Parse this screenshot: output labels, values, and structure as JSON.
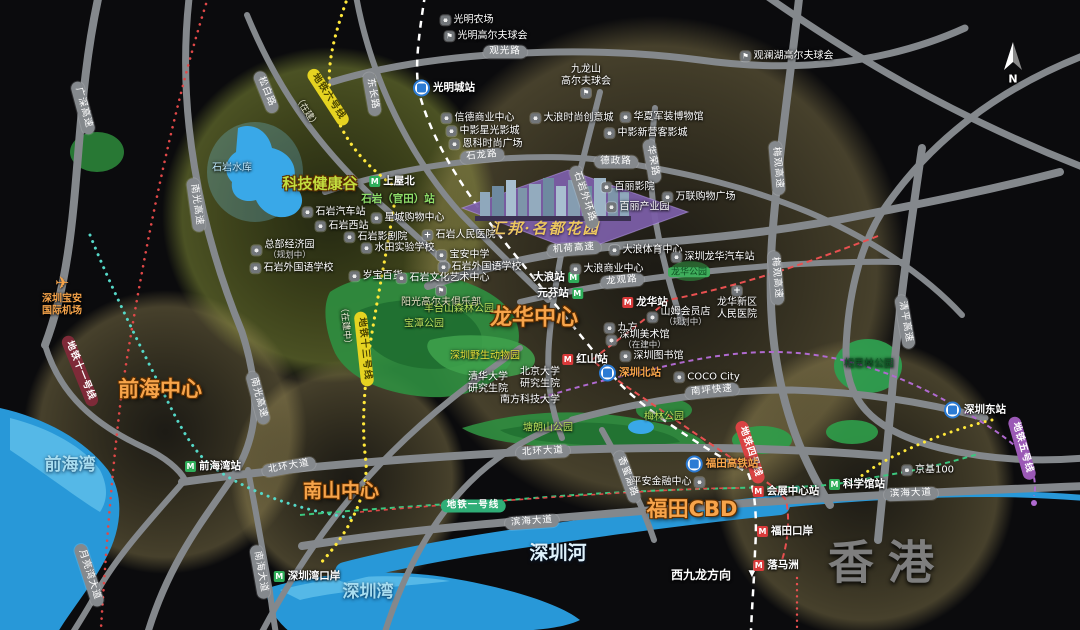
{
  "map": {
    "property": {
      "name": "汇邦·名都花园",
      "x": 545,
      "y": 228
    },
    "compass": {
      "label": "N"
    },
    "regions": [
      {
        "t": "科技健康谷",
        "x": 320,
        "y": 184,
        "s": 15,
        "c": "#c3dd3e"
      },
      {
        "t": "前海中心",
        "x": 160,
        "y": 389,
        "s": 21,
        "c": "#f7a44a"
      },
      {
        "t": "南山中心",
        "x": 341,
        "y": 492,
        "s": 19,
        "c": "#f7a44a"
      },
      {
        "t": "龙华中心",
        "x": 534,
        "y": 318,
        "s": 22,
        "c": "#f7a44a"
      },
      {
        "t": "福田CBD",
        "x": 692,
        "y": 509,
        "s": 21,
        "c": "#f7a44a"
      },
      {
        "t": "香港",
        "x": 888,
        "y": 563,
        "s": 46,
        "c": "#7e7e7e",
        "ls": 14,
        "hk": true
      }
    ],
    "water_labels": [
      {
        "t": "前海湾",
        "x": 70,
        "y": 466
      },
      {
        "t": "深圳湾",
        "x": 368,
        "y": 593
      },
      {
        "t": "深圳河",
        "x": 558,
        "y": 554,
        "s": 19,
        "c": "#dff2fc"
      }
    ],
    "roads": [
      {
        "t": "广深高速",
        "x": 83,
        "y": 108,
        "r": 75
      },
      {
        "t": "松白路",
        "x": 266,
        "y": 92,
        "r": 68
      },
      {
        "t": "东长路",
        "x": 372,
        "y": 94,
        "r": 80
      },
      {
        "t": "南光高速",
        "x": 196,
        "y": 205,
        "r": 82
      },
      {
        "t": "南光高速",
        "x": 258,
        "y": 398,
        "r": 75
      },
      {
        "t": "观光路",
        "x": 505,
        "y": 52,
        "r": 0
      },
      {
        "t": "石龙路",
        "x": 482,
        "y": 156,
        "r": -6
      },
      {
        "t": "德政路",
        "x": 616,
        "y": 162,
        "r": 0
      },
      {
        "t": "华荣路",
        "x": 652,
        "y": 161,
        "r": 80
      },
      {
        "t": "石岩外环路",
        "x": 584,
        "y": 197,
        "r": 72
      },
      {
        "t": "机荷高速",
        "x": 574,
        "y": 249,
        "r": -4
      },
      {
        "t": "龙观路",
        "x": 622,
        "y": 281,
        "r": -5
      },
      {
        "t": "梅观高速",
        "x": 777,
        "y": 168,
        "r": 85
      },
      {
        "t": "梅观高速",
        "x": 776,
        "y": 278,
        "r": 85
      },
      {
        "t": "清平高速",
        "x": 905,
        "y": 322,
        "r": 80
      },
      {
        "t": "南坪快速",
        "x": 712,
        "y": 391,
        "r": -5
      },
      {
        "t": "北环大道",
        "x": 289,
        "y": 467,
        "r": -10
      },
      {
        "t": "北环大道",
        "x": 543,
        "y": 452,
        "r": -3
      },
      {
        "t": "滨海大道",
        "x": 532,
        "y": 522,
        "r": -4
      },
      {
        "t": "滨海大道",
        "x": 911,
        "y": 494,
        "r": -2
      },
      {
        "t": "月亮湾大道",
        "x": 89,
        "y": 575,
        "r": 72
      },
      {
        "t": "南海大道",
        "x": 260,
        "y": 572,
        "r": 80
      },
      {
        "t": "香蜜湖路",
        "x": 627,
        "y": 477,
        "r": 70
      }
    ],
    "metro_lines": [
      {
        "t": "地铁六号线",
        "x": 328,
        "y": 97,
        "r": 57,
        "bg": "#e5d321",
        "fg": "#4a4400"
      },
      {
        "t": "地铁十三号线",
        "x": 364,
        "y": 349,
        "r": 84,
        "bg": "#e5d321",
        "fg": "#4a4400"
      },
      {
        "t": "地铁十一号线",
        "x": 80,
        "y": 371,
        "r": 68,
        "bg": "#7e2a38",
        "fg": "#ffffff"
      },
      {
        "t": "地铁一号线",
        "x": 473,
        "y": 506,
        "r": 0,
        "bg": "#2fae77",
        "fg": "#ffffff"
      },
      {
        "t": "地铁四号线",
        "x": 750,
        "y": 452,
        "r": 72,
        "bg": "#d94343",
        "fg": "#ffffff"
      },
      {
        "t": "地铁五号线",
        "x": 1022,
        "y": 448,
        "r": 74,
        "bg": "#9b59b6",
        "fg": "#ffffff"
      }
    ],
    "stations": [
      {
        "t": "光明城站",
        "x": 444,
        "y": 88,
        "i": "rail"
      },
      {
        "t": "上屋北",
        "x": 392,
        "y": 181,
        "i": "mg"
      },
      {
        "t": "石岩（官田）站",
        "x": 398,
        "y": 199,
        "c": "#8fe06a"
      },
      {
        "t": "大浪站",
        "x": 556,
        "y": 277,
        "i": "mg",
        "side": "r"
      },
      {
        "t": "元芬站",
        "x": 560,
        "y": 293,
        "i": "mg",
        "side": "r"
      },
      {
        "t": "龙华站",
        "x": 645,
        "y": 302,
        "i": "mr"
      },
      {
        "t": "红山站",
        "x": 585,
        "y": 359,
        "i": "mr"
      },
      {
        "t": "深圳北站",
        "x": 630,
        "y": 373,
        "i": "rail",
        "c": "#f7a44a",
        "b": true
      },
      {
        "t": "深圳东站",
        "x": 975,
        "y": 410,
        "i": "rail"
      },
      {
        "t": "前海湾站",
        "x": 213,
        "y": 466,
        "i": "mg"
      },
      {
        "t": "深圳湾口岸",
        "x": 307,
        "y": 576,
        "i": "mg"
      },
      {
        "t": "会展中心站",
        "x": 786,
        "y": 491,
        "i": "mr"
      },
      {
        "t": "科学馆站",
        "x": 857,
        "y": 484,
        "i": "mg"
      },
      {
        "t": "福田高铁站",
        "x": 722,
        "y": 464,
        "i": "rail",
        "c": "#f7a44a",
        "b": true
      },
      {
        "t": "福田口岸",
        "x": 785,
        "y": 531,
        "i": "mr"
      },
      {
        "t": "落马洲",
        "x": 776,
        "y": 565,
        "i": "mr"
      }
    ],
    "pois": [
      {
        "t": "光明农场",
        "x": 467,
        "y": 20
      },
      {
        "t": "光明高尔夫球会",
        "x": 486,
        "y": 36,
        "i": "flag"
      },
      {
        "t": "观澜湖高尔夫球会",
        "x": 787,
        "y": 56,
        "i": "flag"
      },
      {
        "t": "九龙山\n高尔夫球会",
        "x": 586,
        "y": 81,
        "i": "flag",
        "ip": "below"
      },
      {
        "t": "信德商业中心",
        "x": 478,
        "y": 118
      },
      {
        "t": "中影星光影城",
        "x": 483,
        "y": 131
      },
      {
        "t": "恩科时尚广场",
        "x": 486,
        "y": 144
      },
      {
        "t": "大浪时尚创意城",
        "x": 572,
        "y": 118
      },
      {
        "t": "华夏军装博物馆",
        "x": 662,
        "y": 117
      },
      {
        "t": "中影新营客影城",
        "x": 646,
        "y": 133
      },
      {
        "t": "百丽影院",
        "x": 628,
        "y": 187
      },
      {
        "t": "百丽产业园",
        "x": 638,
        "y": 207
      },
      {
        "t": "万联购物广场",
        "x": 699,
        "y": 197
      },
      {
        "t": "石岩汽车站",
        "x": 334,
        "y": 212
      },
      {
        "t": "石岩西站",
        "x": 342,
        "y": 226
      },
      {
        "t": "星城购物中心",
        "x": 408,
        "y": 218
      },
      {
        "t": "石岩影剧院",
        "x": 376,
        "y": 237
      },
      {
        "t": "石岩人民医院",
        "x": 459,
        "y": 235,
        "i": "plus"
      },
      {
        "t": "水田实验学校",
        "x": 398,
        "y": 248
      },
      {
        "t": "宝安中学",
        "x": 463,
        "y": 255
      },
      {
        "t": "石岩外国语学校",
        "x": 480,
        "y": 267
      },
      {
        "t": "岁宝百货",
        "x": 376,
        "y": 276
      },
      {
        "t": "石岩文化艺术中心",
        "x": 443,
        "y": 278
      },
      {
        "t": "总部经济园",
        "x": 283,
        "y": 250,
        "n": "（规划中）"
      },
      {
        "t": "石岩外国语学校",
        "x": 292,
        "y": 268
      },
      {
        "t": "阳光高尔夫俱乐部",
        "x": 441,
        "y": 297,
        "i": "flag",
        "ip": "above",
        "c": "#e9e5c6"
      },
      {
        "t": "羊台山森林公园",
        "x": 459,
        "y": 309,
        "i": "none",
        "c": "#b8e05c"
      },
      {
        "t": "宝潭公园",
        "x": 424,
        "y": 324,
        "i": "none",
        "c": "#b8e05c"
      },
      {
        "t": "深圳野生动物园",
        "x": 485,
        "y": 356,
        "i": "none",
        "c": "#e6e03a"
      },
      {
        "t": "清华大学\n研究生院",
        "x": 488,
        "y": 383,
        "i": "none"
      },
      {
        "t": "北京大学\n研究生院",
        "x": 540,
        "y": 378,
        "i": "none"
      },
      {
        "t": "南方科技大学",
        "x": 530,
        "y": 400,
        "i": "none"
      },
      {
        "t": "塘朗山公园",
        "x": 548,
        "y": 428,
        "i": "none",
        "c": "#b8e05c"
      },
      {
        "t": "梅林公园",
        "x": 664,
        "y": 417,
        "i": "none",
        "c": "#b8e05c"
      },
      {
        "t": "相思林公园",
        "x": 869,
        "y": 364,
        "i": "none",
        "c": "#0f5c28"
      },
      {
        "t": "龙华公园",
        "x": 689,
        "y": 272,
        "i": "none",
        "chip": true
      },
      {
        "t": "大浪体育中心",
        "x": 646,
        "y": 250
      },
      {
        "t": "大浪商业中心",
        "x": 607,
        "y": 269
      },
      {
        "t": "深圳龙华汽车站",
        "x": 713,
        "y": 257
      },
      {
        "t": "龙华新区\n人民医院",
        "x": 737,
        "y": 303,
        "i": "plus",
        "ip": "above"
      },
      {
        "t": "山姆会员店",
        "x": 679,
        "y": 317,
        "n": "（规划中）"
      },
      {
        "t": "九方",
        "x": 621,
        "y": 328
      },
      {
        "t": "深圳美术馆",
        "x": 638,
        "y": 340,
        "n": "（在建中）"
      },
      {
        "t": "深圳图书馆",
        "x": 652,
        "y": 356
      },
      {
        "t": "COCO City",
        "x": 707,
        "y": 377
      },
      {
        "t": "京基100",
        "x": 928,
        "y": 470
      },
      {
        "t": "平安金融中心",
        "x": 668,
        "y": 482,
        "ip": "r"
      },
      {
        "t": "石岩水库",
        "x": 232,
        "y": 168,
        "i": "none",
        "c": "#bfe9ff"
      },
      {
        "t": "深圳宝安\n国际机场",
        "x": 62,
        "y": 296,
        "i": "plane",
        "ip": "above",
        "c": "#f7a44a",
        "b": true
      }
    ],
    "notes": [
      {
        "t": "（在建）",
        "x": 306,
        "y": 112,
        "r": 57,
        "c": "#efefd8",
        "s": 9
      },
      {
        "t": "（在建中）",
        "x": 345,
        "y": 326,
        "r": 84,
        "c": "#efefd8",
        "s": 9
      },
      {
        "t": "N",
        "x": 1013,
        "y": 80,
        "c": "#ffffff",
        "s": 11,
        "b": true
      },
      {
        "t": "西九龙方向",
        "x": 701,
        "y": 576,
        "c": "#ffffff",
        "s": 12,
        "b": true
      },
      {
        "t": "▼",
        "x": 752,
        "y": 574,
        "c": "#ffffff",
        "s": 9
      }
    ]
  }
}
